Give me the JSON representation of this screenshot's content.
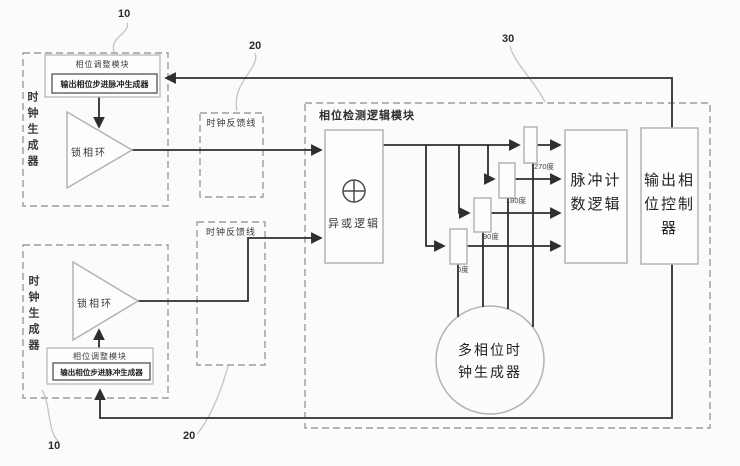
{
  "figure": {
    "refs": {
      "top_left": "10",
      "feedback_top": "20",
      "phase_logic": "30",
      "bottom_left": "10",
      "feedback_bottom": "20"
    },
    "clock_gen_top": {
      "title": "时钟生成器",
      "pll": "锁相环",
      "adjust_module": "相位调整模块",
      "pulse_gen": "输出相位步进脉冲生成器"
    },
    "clock_gen_bottom": {
      "title": "时钟生成器",
      "pll": "锁相环",
      "adjust_module": "相位调整模块",
      "pulse_gen": "输出相位步进脉冲生成器"
    },
    "feedback_line_top": "时钟反馈线",
    "feedback_line_bottom": "时钟反馈线",
    "phase_logic": {
      "title": "相位检测逻辑模块",
      "xor_icon": "circle-plus",
      "xor_label": "异或逻辑",
      "taps": [
        "0度",
        "90度",
        "180度",
        "270度"
      ],
      "pulse_counter": [
        "脉冲计",
        "数逻辑"
      ],
      "phase_controller": [
        "输出相",
        "位控制",
        "器"
      ],
      "multiphase_clock": [
        "多相位时",
        "钟生成器"
      ]
    },
    "colors": {
      "signal_line": "#2e2e2e",
      "component_border": "#b3b3b3",
      "dashed_border": "#9c9c9c"
    }
  }
}
